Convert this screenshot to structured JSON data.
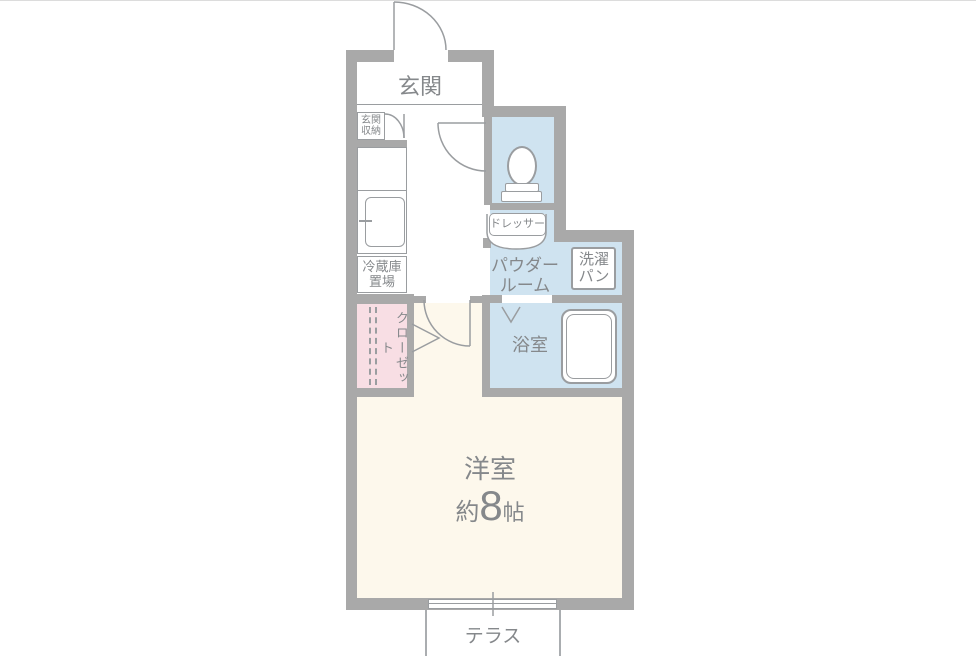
{
  "title": "apartment-floor-plan",
  "colors": {
    "wall": "#a9a9a9",
    "wet_area_blue": "#cfe3f0",
    "closet_pink": "#f8dee4",
    "main_room_cream": "#fdf8ec",
    "label_text": "#85888b",
    "fixture_line": "#9a9da0"
  },
  "rooms": {
    "entrance": {
      "label": "玄関"
    },
    "entrance_storage": {
      "label_line1": "玄関",
      "label_line2": "収納"
    },
    "fridge_space": {
      "label_line1": "冷蔵庫",
      "label_line2": "置場"
    },
    "dresser": {
      "label": "ドレッサー"
    },
    "powder_room": {
      "label_line1": "パウダー",
      "label_line2": "ルーム"
    },
    "laundry_pan": {
      "label_line1": "洗濯",
      "label_line2": "パン"
    },
    "bathroom": {
      "label": "浴室"
    },
    "closet": {
      "label": "クローゼット"
    },
    "main_room": {
      "label": "洋室",
      "size_prefix": "約",
      "size_value": "8",
      "size_unit": "帖"
    },
    "terrace": {
      "label": "テラス"
    }
  }
}
